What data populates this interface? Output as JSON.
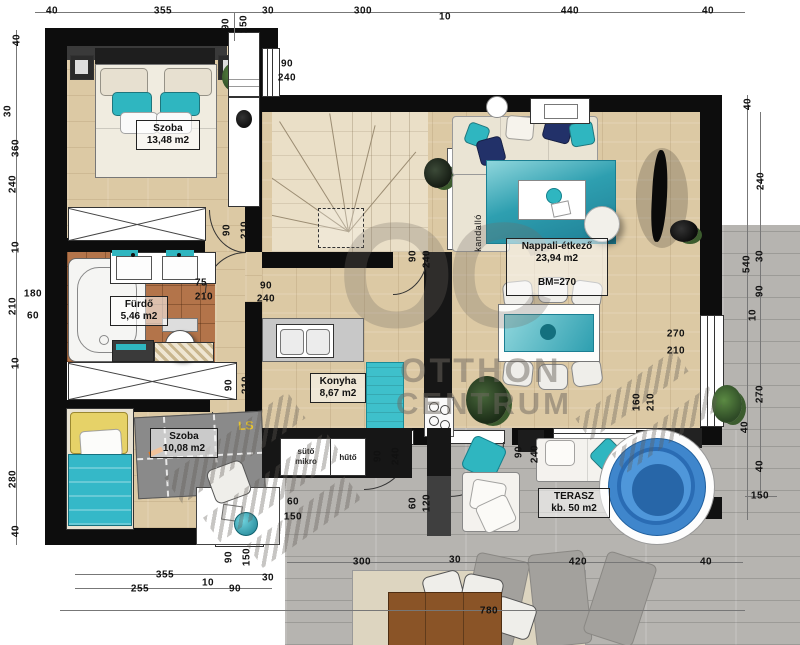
{
  "watermark": {
    "monogram": "OC",
    "line1": "OTTHON",
    "line2": "CENTRUM"
  },
  "rooms": {
    "bedroom1": {
      "name": "Szoba",
      "area": "13,48 m2"
    },
    "bathroom": {
      "name": "Fürdő",
      "area": "5,46 m2"
    },
    "bedroom2": {
      "name": "Szoba",
      "area": "10,08 m2"
    },
    "kitchen": {
      "name": "Konyha",
      "area": "8,67 m2"
    },
    "living": {
      "name": "Nappali-étkező",
      "area": "23,94 m2",
      "height_note": "BM=270"
    },
    "terrace": {
      "name": "TERASZ",
      "area": "kb. 50 m2"
    }
  },
  "appliances": {
    "oven": "sütő mikro",
    "fridge": "hűtő"
  },
  "fixtures": {
    "fireplace": "kandalló"
  },
  "toy_rug_text": "LS",
  "colors": {
    "accent_teal": "#2fb6c0",
    "wall": "#0d0d0d",
    "wood": "#dcc9a4",
    "tile": "#b3744a",
    "deck": "#b6b4b0",
    "pool_blue": "#3f86cc"
  },
  "dimension_labels": [
    {
      "t": "40",
      "x": 52,
      "y": 11
    },
    {
      "t": "355",
      "x": 163,
      "y": 11
    },
    {
      "t": "30",
      "x": 268,
      "y": 11
    },
    {
      "t": "300",
      "x": 363,
      "y": 11
    },
    {
      "t": "10",
      "x": 445,
      "y": 17
    },
    {
      "t": "440",
      "x": 570,
      "y": 11
    },
    {
      "t": "40",
      "x": 708,
      "y": 11
    },
    {
      "t": "90",
      "x": 226,
      "y": 24,
      "r": 1
    },
    {
      "t": "150",
      "x": 244,
      "y": 24,
      "r": 1
    },
    {
      "t": "90",
      "x": 287,
      "y": 64
    },
    {
      "t": "240",
      "x": 287,
      "y": 78
    },
    {
      "t": "40",
      "x": 17,
      "y": 40,
      "r": 1
    },
    {
      "t": "30",
      "x": 8,
      "y": 111,
      "r": 1
    },
    {
      "t": "360",
      "x": 16,
      "y": 148,
      "r": 1
    },
    {
      "t": "240",
      "x": 13,
      "y": 184,
      "r": 1
    },
    {
      "t": "10",
      "x": 16,
      "y": 247,
      "r": 1
    },
    {
      "t": "210",
      "x": 13,
      "y": 306,
      "r": 1
    },
    {
      "t": "180",
      "x": 33,
      "y": 294
    },
    {
      "t": "60",
      "x": 33,
      "y": 316
    },
    {
      "t": "10",
      "x": 16,
      "y": 363,
      "r": 1
    },
    {
      "t": "280",
      "x": 13,
      "y": 479,
      "r": 1
    },
    {
      "t": "40",
      "x": 16,
      "y": 531,
      "r": 1
    },
    {
      "t": "40",
      "x": 748,
      "y": 104,
      "r": 1
    },
    {
      "t": "240",
      "x": 761,
      "y": 181,
      "r": 1
    },
    {
      "t": "540",
      "x": 747,
      "y": 264,
      "r": 1
    },
    {
      "t": "30",
      "x": 760,
      "y": 256,
      "r": 1
    },
    {
      "t": "90",
      "x": 760,
      "y": 291,
      "r": 1
    },
    {
      "t": "10",
      "x": 753,
      "y": 315,
      "r": 1
    },
    {
      "t": "270",
      "x": 760,
      "y": 394,
      "r": 1
    },
    {
      "t": "40",
      "x": 745,
      "y": 427,
      "r": 1
    },
    {
      "t": "40",
      "x": 760,
      "y": 466,
      "r": 1
    },
    {
      "t": "150",
      "x": 760,
      "y": 496
    },
    {
      "t": "355",
      "x": 165,
      "y": 575
    },
    {
      "t": "255",
      "x": 140,
      "y": 589
    },
    {
      "t": "10",
      "x": 208,
      "y": 583
    },
    {
      "t": "90",
      "x": 235,
      "y": 589
    },
    {
      "t": "30",
      "x": 268,
      "y": 578
    },
    {
      "t": "90",
      "x": 229,
      "y": 557,
      "r": 1
    },
    {
      "t": "150",
      "x": 247,
      "y": 557,
      "r": 1
    },
    {
      "t": "60",
      "x": 293,
      "y": 502
    },
    {
      "t": "150",
      "x": 293,
      "y": 517
    },
    {
      "t": "300",
      "x": 362,
      "y": 562
    },
    {
      "t": "30",
      "x": 455,
      "y": 560
    },
    {
      "t": "420",
      "x": 578,
      "y": 562
    },
    {
      "t": "40",
      "x": 706,
      "y": 562
    },
    {
      "t": "780",
      "x": 489,
      "y": 611
    },
    {
      "t": "90",
      "x": 227,
      "y": 230,
      "r": 1
    },
    {
      "t": "210",
      "x": 245,
      "y": 230,
      "r": 1
    },
    {
      "t": "75",
      "x": 201,
      "y": 283
    },
    {
      "t": "210",
      "x": 204,
      "y": 297
    },
    {
      "t": "90",
      "x": 229,
      "y": 385,
      "r": 1
    },
    {
      "t": "210",
      "x": 246,
      "y": 385,
      "r": 1
    },
    {
      "t": "90",
      "x": 266,
      "y": 286
    },
    {
      "t": "240",
      "x": 266,
      "y": 299
    },
    {
      "t": "90",
      "x": 413,
      "y": 256,
      "r": 1
    },
    {
      "t": "240",
      "x": 427,
      "y": 259,
      "r": 1
    },
    {
      "t": "90",
      "x": 378,
      "y": 456,
      "r": 1
    },
    {
      "t": "240",
      "x": 396,
      "y": 456,
      "r": 1
    },
    {
      "t": "60",
      "x": 413,
      "y": 503,
      "r": 1
    },
    {
      "t": "120",
      "x": 427,
      "y": 503,
      "r": 1
    },
    {
      "t": "90",
      "x": 519,
      "y": 452,
      "r": 1
    },
    {
      "t": "240",
      "x": 535,
      "y": 454,
      "r": 1
    },
    {
      "t": "160",
      "x": 637,
      "y": 402,
      "r": 1
    },
    {
      "t": "210",
      "x": 651,
      "y": 402,
      "r": 1
    },
    {
      "t": "270",
      "x": 676,
      "y": 334
    },
    {
      "t": "210",
      "x": 676,
      "y": 351
    }
  ]
}
